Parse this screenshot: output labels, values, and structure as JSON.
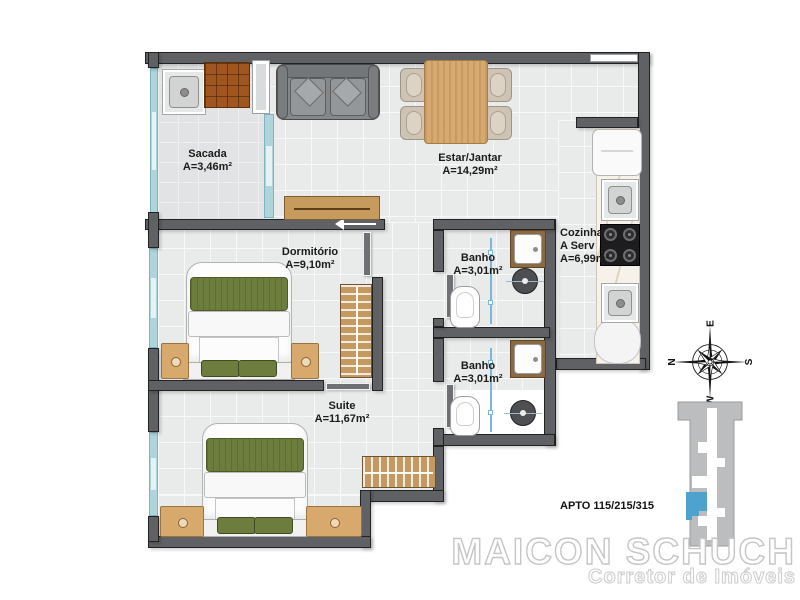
{
  "plan_title": "Apartment floor plan",
  "rooms": {
    "sacada": {
      "name": "Sacada",
      "area": "A=3,46m²"
    },
    "estar": {
      "name": "Estar/Jantar",
      "area": "A=14,29m²"
    },
    "cozinha": {
      "name": "Cozinha",
      "name2": "A Serv",
      "area": "A=6,99m²"
    },
    "dormitorio": {
      "name": "Dormitório",
      "area": "A=9,10m²"
    },
    "banho1": {
      "name": "Banho",
      "area": "A=3,01m²"
    },
    "banho2": {
      "name": "Banho",
      "area": "A=3,01m²"
    },
    "suite": {
      "name": "Suite",
      "area": "A=11,67m²"
    }
  },
  "compass": {
    "top": "E",
    "left": "N",
    "right": "S",
    "bottom": "W"
  },
  "unit_label": "APTO 115/215/315",
  "watermark": {
    "name": "MAICON SCHUCH",
    "tagline": "Corretor de Imóveis"
  },
  "colors": {
    "wall": "#5f6164",
    "floor": "#e9eaea",
    "glass": "#aed4dc",
    "wood": "#d8a96c",
    "bedding_green": "#6d7d3e",
    "brick": "#a0561f",
    "keyplan_unit_blue": "#4da3cd",
    "watermark_outline": "#c6c6c6"
  }
}
